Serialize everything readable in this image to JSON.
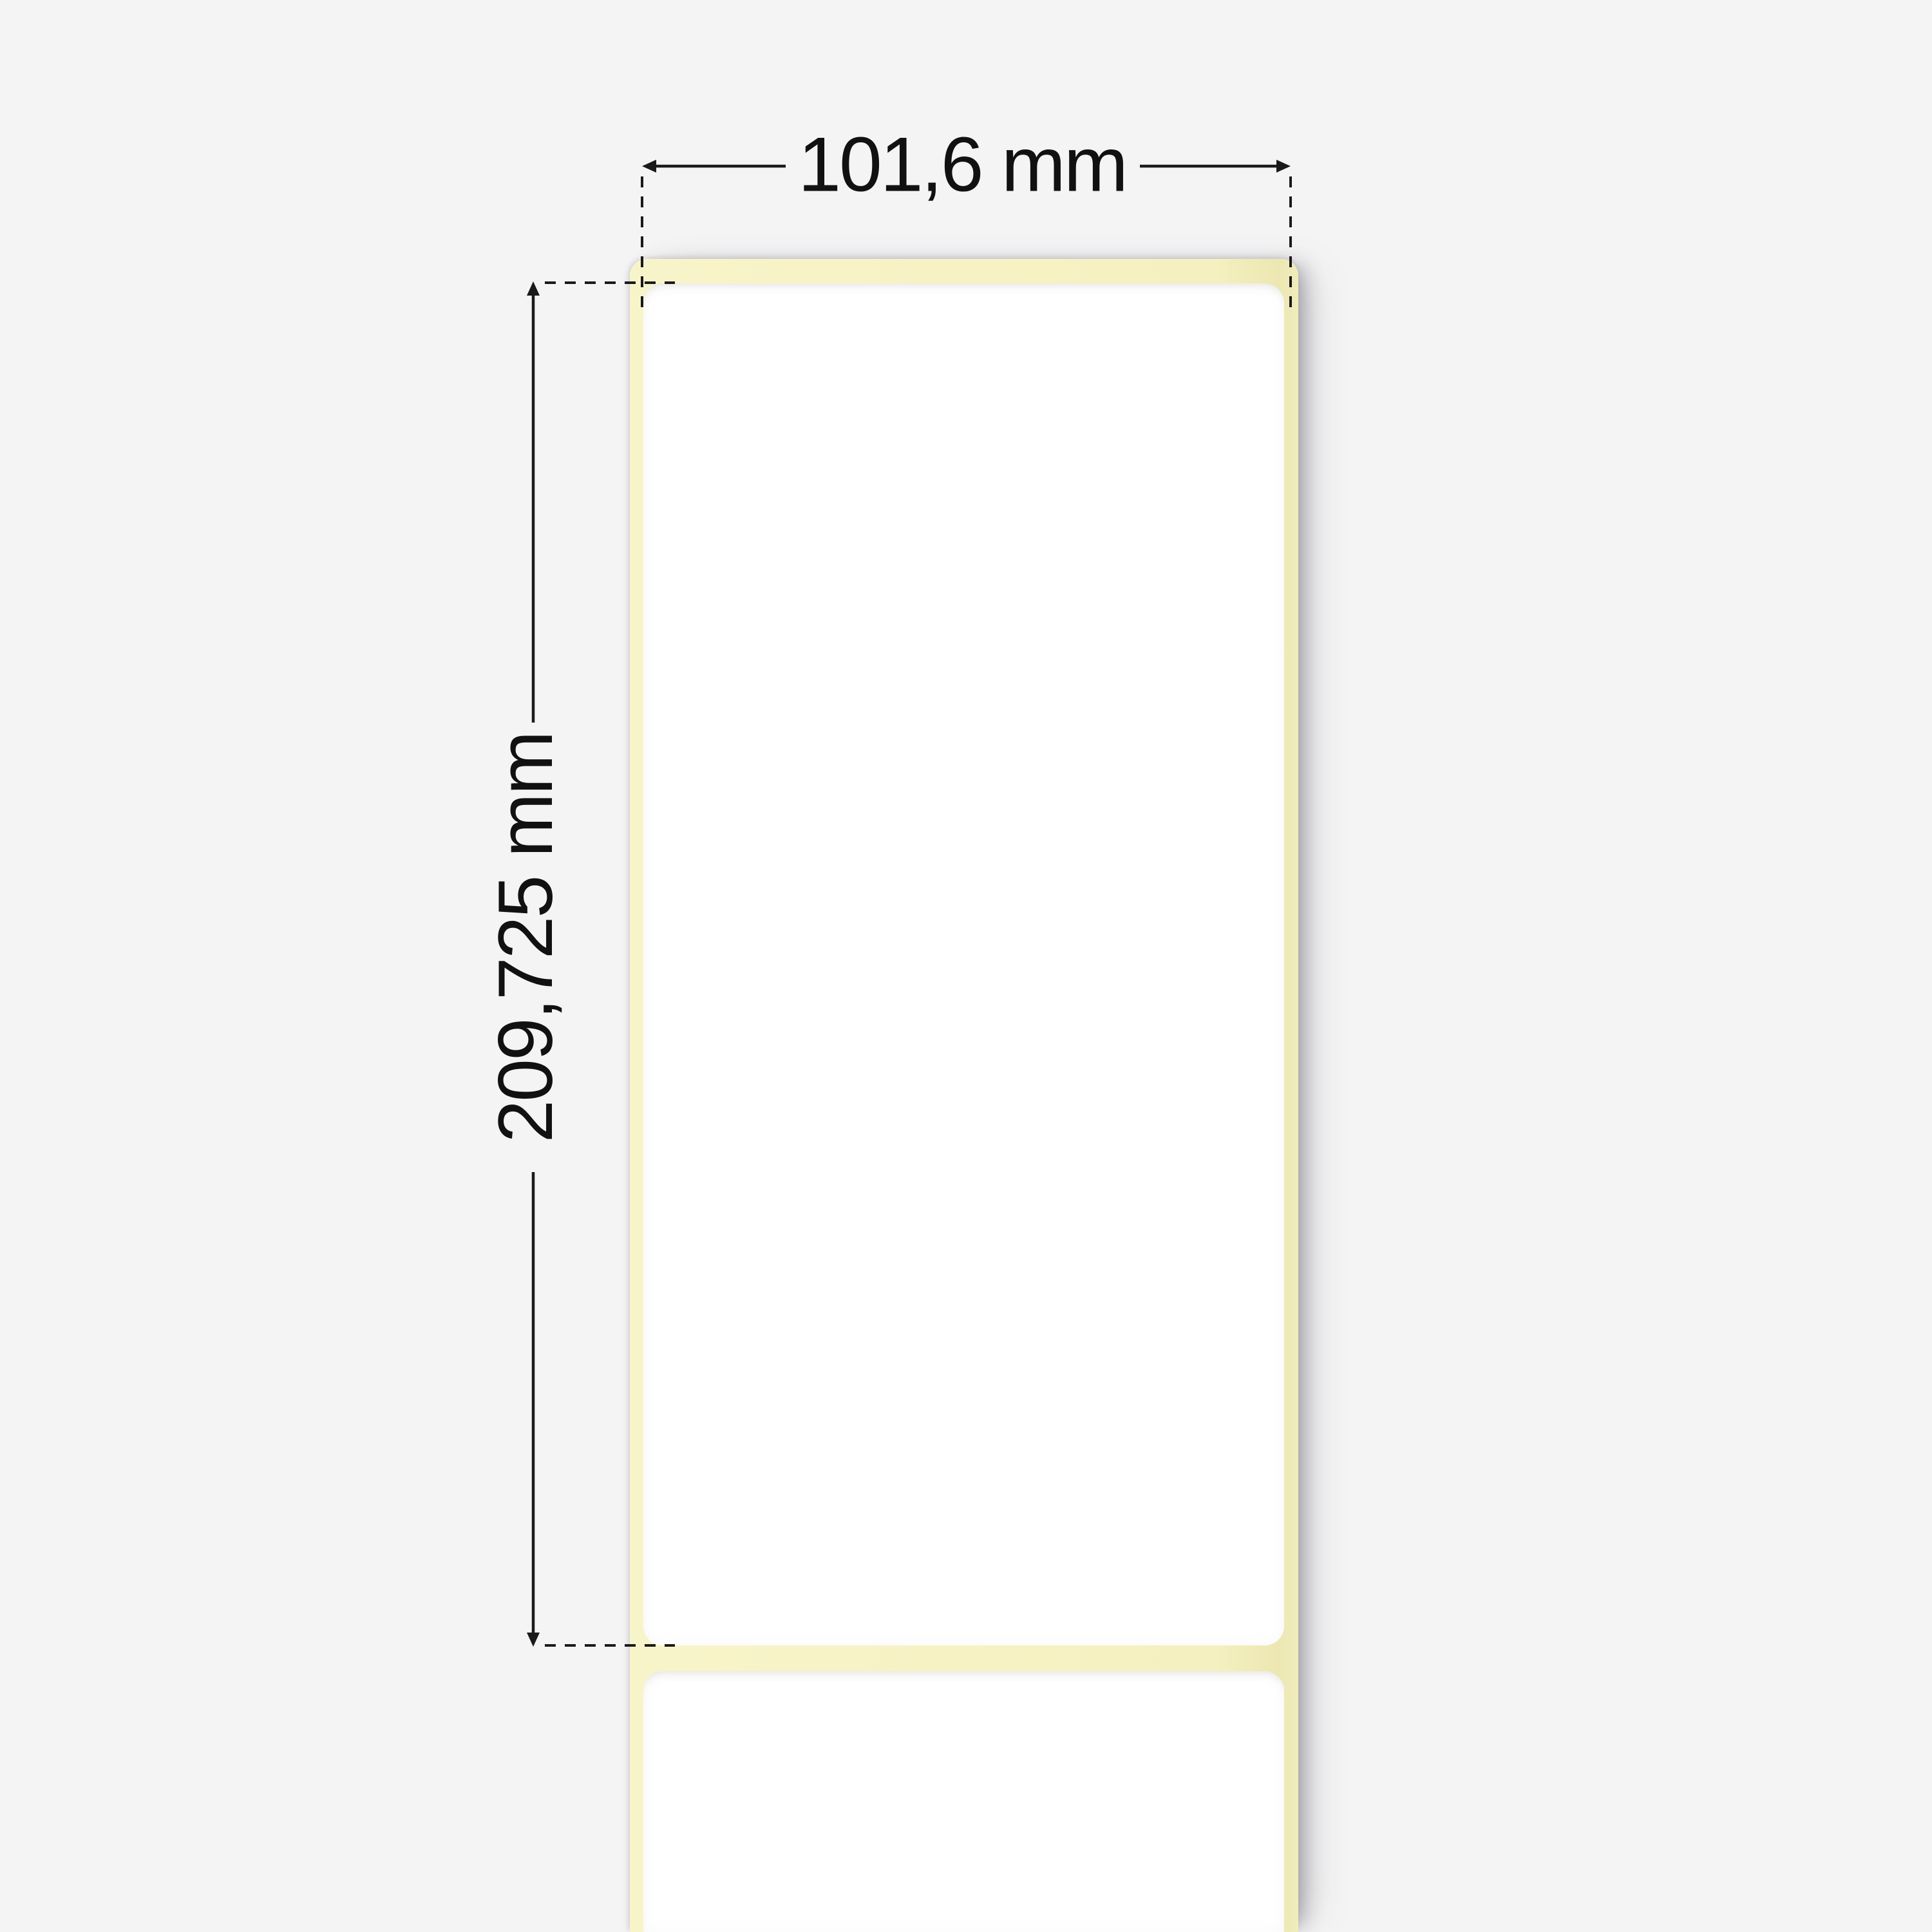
{
  "diagram": {
    "type": "label-roll-dimension-diagram",
    "width_dimension": {
      "label": "101,6 mm"
    },
    "height_dimension": {
      "label": "209,725 mm"
    }
  },
  "colors": {
    "background": "#f4f4f5",
    "liner": "#f6f2c3",
    "label": "#ffffff",
    "annotation": "#1a1a1a",
    "text": "#111111"
  }
}
